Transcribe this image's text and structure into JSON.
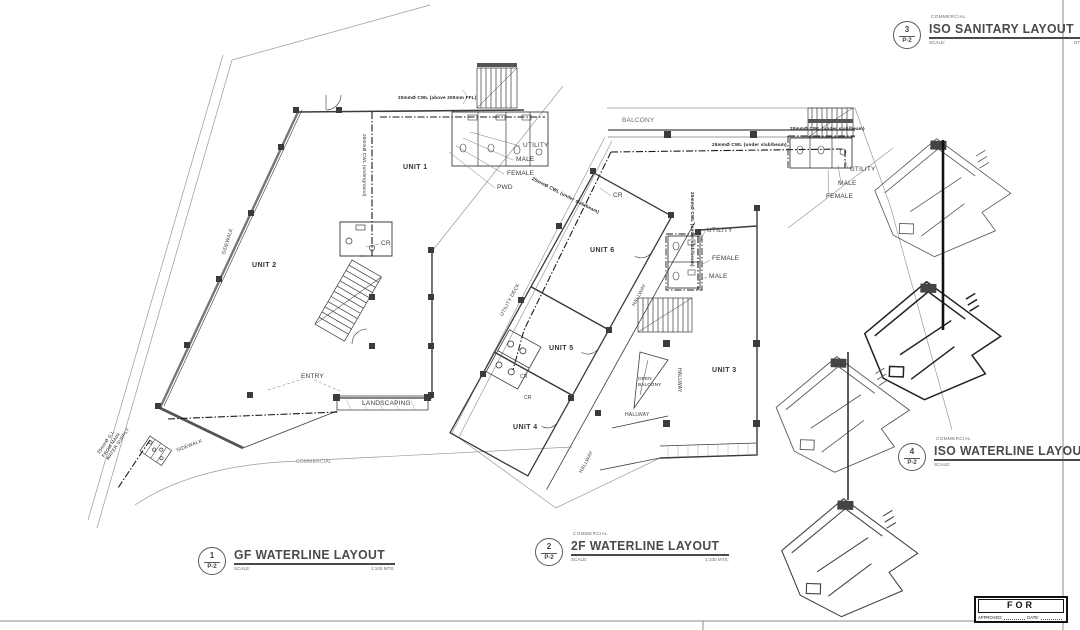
{
  "page": {
    "background": "#ffffff",
    "line_color": "#3a3a3a"
  },
  "titleblocks": {
    "gf": {
      "number": "1",
      "sheet": "P-2",
      "category": "",
      "title": "GF WATERLINE LAYOUT",
      "scale_label": "SCALE:",
      "scale_value": "1:100 MTS."
    },
    "f2": {
      "number": "2",
      "sheet": "P-2",
      "category": "COMMERCIAL",
      "title": "2F WATERLINE LAYOUT",
      "scale_label": "SCALE:",
      "scale_value": "1:100 MTS."
    },
    "iso_sanitary": {
      "number": "3",
      "sheet": "P-2",
      "category": "COMMERCIAL",
      "title": "ISO SANITARY LAYOUT",
      "scale_label": "SCALE:",
      "scale_value": "NTS"
    },
    "iso_waterline": {
      "number": "4",
      "sheet": "P-2",
      "category": "COMMERCIAL",
      "title": "ISO WATERLINE LAYOUT",
      "scale_label": "SCALE:",
      "scale_value": "NTS"
    }
  },
  "gf_plan": {
    "unit1": "UNIT 1",
    "unit2": "UNIT 2",
    "cr": "CR",
    "utility": "UTILITY",
    "male": "MALE",
    "female": "FEMALE",
    "pwd": "PWD",
    "entry": "ENTRY",
    "landscaping": "LANDSCAPING",
    "sidewalk": "SIDEWALK",
    "commercial": "COMMERCIAL",
    "note_cwl_above": "20mmØ CWL (above 200mm FFL)",
    "note_cwl_underground": "20mmØ CWL (underground)",
    "note_supply": "25mmØ G.I.\nFROM MAIN\nWATER SUPPLY"
  },
  "f2_plan": {
    "balcony": "BALCONY",
    "unit3": "UNIT 3",
    "unit4": "UNIT 4",
    "unit5": "UNIT 5",
    "unit6": "UNIT 6",
    "cr": "CR",
    "utility": "UTILITY",
    "male": "MALE",
    "female": "FEMALE",
    "hallway": "HALLWAY",
    "utility_deck": "UTILITY DECK",
    "open_balcony": "OPEN\nBALCONY",
    "note_cwl_25": "25mmØ CWL (under slab/beam)",
    "note_cwl_20": "20mmØ CWL (under slab/beam)"
  },
  "permit_stamp": {
    "title": "FOR PERMIT",
    "approved_label": "APPROVED:",
    "date_label": "DATE:"
  }
}
